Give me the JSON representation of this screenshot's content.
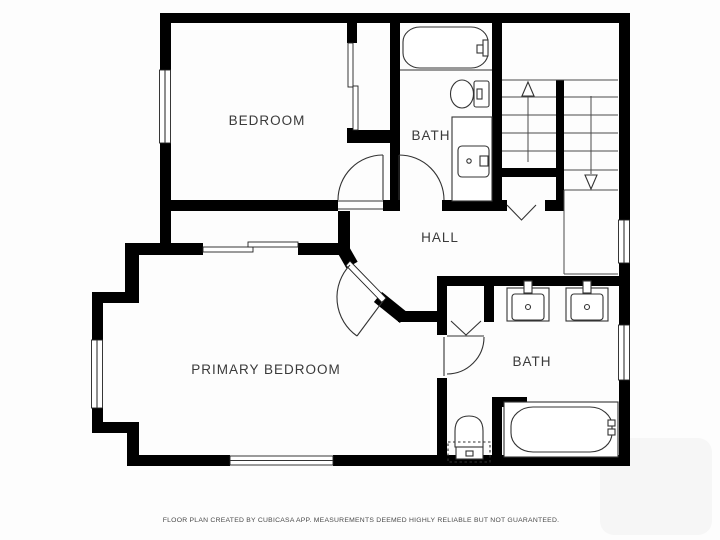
{
  "colors": {
    "wall": "#000000",
    "background": "#fdfdfd",
    "fixture_line": "#333333",
    "label_text": "#3a3a3a"
  },
  "rooms": {
    "bedroom": {
      "label": "BEDROOM"
    },
    "bath_upper": {
      "label": "BATH"
    },
    "hall": {
      "label": "HALL"
    },
    "primary_bedroom": {
      "label": "PRIMARY BEDROOM"
    },
    "bath_lower": {
      "label": "BATH"
    }
  },
  "footer": {
    "disclaimer": "FLOOR PLAN CREATED BY CUBICASA APP. MEASUREMENTS DEEMED HIGHLY RELIABLE BUT NOT GUARANTEED."
  }
}
